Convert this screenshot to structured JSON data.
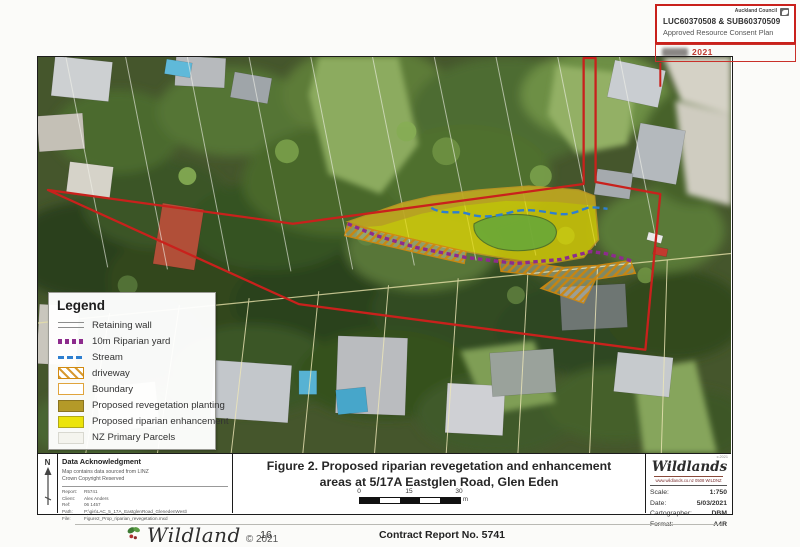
{
  "consent_stamp": {
    "council": "Auckland Council",
    "ref_line": "LUC60370508 & SUB60370509",
    "plan_line": "Approved Resource Consent Plan",
    "date_partial": "2021"
  },
  "map": {
    "overlay_colors": {
      "boundary_red": "#c9211c",
      "stream_blue": "#2e7fd0",
      "riparian_yard_purple": "#8d2b8d",
      "driveway_orange": "#d28a10",
      "enhancement_yellow": "#e8dc00",
      "revegetation_khaki": "#b49a28"
    }
  },
  "legend": {
    "title": "Legend",
    "items": [
      {
        "label": "Retaining wall"
      },
      {
        "label": "10m Riparian yard"
      },
      {
        "label": "Stream"
      },
      {
        "label": "driveway"
      },
      {
        "label": "Boundary"
      },
      {
        "label": "Proposed revegetation planting"
      },
      {
        "label": "Proposed riparian enhancement"
      },
      {
        "label": "NZ Primary Parcels"
      }
    ]
  },
  "north_label": "N",
  "data_ack": {
    "title": "Data Acknowledgment",
    "source_line1": "Map contains data sourced from LINZ",
    "source_line2": "Crown Copyright Reserved",
    "rows": [
      {
        "label": "Report:",
        "value": "R5741"
      },
      {
        "label": "Client:",
        "value": "Alex Anders"
      },
      {
        "label": "Ref:",
        "value": "06 1457"
      },
      {
        "label": "Path:",
        "value": "P:\\gis\\LAC_5_17A_EastglenRoad_GlenedenWest\\"
      },
      {
        "label": "File:",
        "value": "Figure2_Prop_riparian_revegetation.mxd"
      }
    ]
  },
  "title_block": {
    "line1": "Figure 2. Proposed riparian revegetation and enhancement",
    "line2": "areas at 5/17A Eastglen Road, Glen Eden",
    "scale_ticks": [
      "0",
      "15",
      "30"
    ],
    "scale_unit": "m"
  },
  "wildlands_block": {
    "brand": "Wildlands",
    "tagline": "www.wildlands.co.nz  0508 WILDNZ",
    "corner_note": "c.2021",
    "rows": [
      {
        "label": "Scale:",
        "value": "1:750"
      },
      {
        "label": "Date:",
        "value": "5/03/2021"
      },
      {
        "label": "Cartographer:",
        "value": "DBM"
      },
      {
        "label": "Format:",
        "value": "A4R"
      }
    ]
  },
  "footer": {
    "brand": "Wildland",
    "copyright": "© 2021",
    "page_number": "16",
    "report_no": "Contract Report No. 5741"
  }
}
